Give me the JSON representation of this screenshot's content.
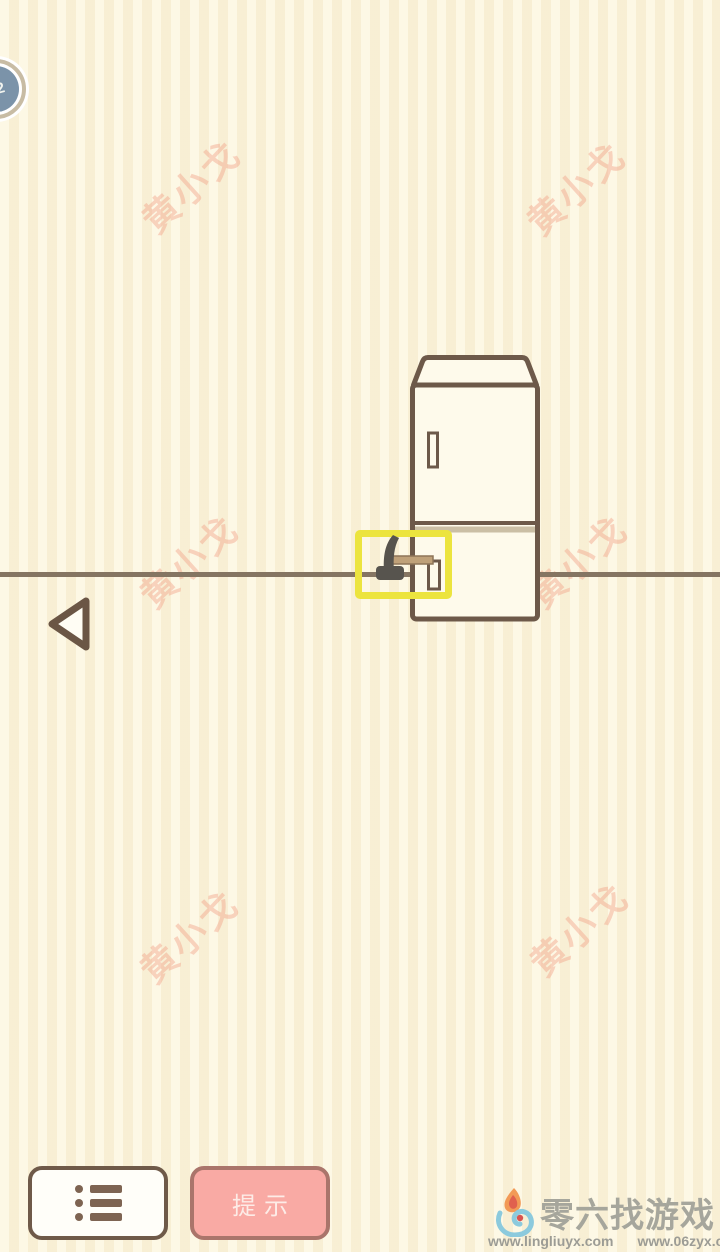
{
  "level_badge": {
    "number": "22"
  },
  "watermark": {
    "text": "黄小戈"
  },
  "scene": {
    "objects": {
      "fridge": "fridge",
      "hammer": "hammer"
    },
    "hint_box_color": "#ece43e"
  },
  "buttons": {
    "hint_label": "提示",
    "menu_icon": "list-icon",
    "back_icon": "back-arrow-icon"
  },
  "footer": {
    "site_name": "零六找游戏",
    "urls": [
      "www.lingliuyx.com",
      "www.06zyx.com"
    ]
  },
  "colors": {
    "background": "#faf2d8",
    "outline_brown": "#6d5949",
    "floor": "#857562",
    "hint_yellow": "#ece43e",
    "button_pink": "#f9aaa4",
    "watermark_pink": "#f09e84",
    "badge_blue": "#7b93a9"
  }
}
